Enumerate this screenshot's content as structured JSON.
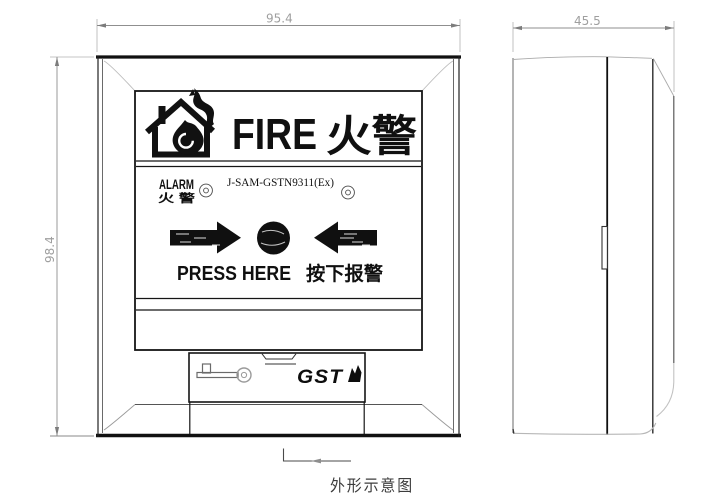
{
  "drawing": {
    "caption": "外形示意图",
    "type_label": "outline-schematic-of-fire-alarm-call-point"
  },
  "dimensions": {
    "width_mm": "95.4",
    "height_mm": "98.4",
    "depth_mm": "45.5"
  },
  "front_panel": {
    "header": {
      "fire_en": "FIRE",
      "fire_cn": "火警"
    },
    "status_row": {
      "alarm_en": "ALARM",
      "alarm_cn": "火 警",
      "model": "J-SAM-GSTN9311(Ex)"
    },
    "action_row": {
      "press_en": "PRESS HERE",
      "press_cn": "按下报警"
    },
    "footer": {
      "brand": "GST"
    }
  },
  "icons": {
    "fire_house_icon": "house with flame pictogram",
    "alarm_led_icon": "concentric-circle LED indicator (x2)",
    "press_arrow_icons": "left/right solid arrows toward center button",
    "press_button_icon": "solid round push element",
    "reset_key_icon": "reset key with ring head",
    "gst_flame_icon": "brush flame mark after brand"
  },
  "colors": {
    "line": "#1a1a1a",
    "light_line": "#b0b0b0",
    "dim_text": "#9f9f9f",
    "background": "#ffffff"
  }
}
